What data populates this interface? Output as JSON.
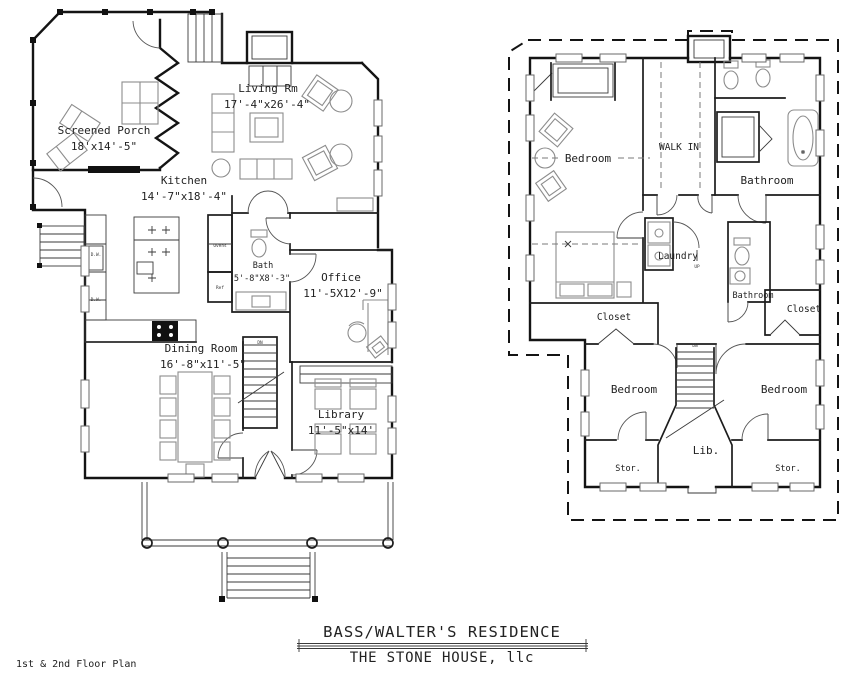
{
  "sheet": {
    "plan_note": "1st & 2nd Floor Plan",
    "title": "BASS/WALTER'S RESIDENCE",
    "firm": "THE STONE HOUSE, llc"
  },
  "style": {
    "ink": "#141414",
    "furniture": "#8c8c8c",
    "paper": "#ffffff"
  },
  "first_floor": {
    "rooms": [
      {
        "name": "Screened Porch",
        "dims": "18'x14'-5\""
      },
      {
        "name": "Living Rm",
        "dims": "17'-4\"x26'-4\""
      },
      {
        "name": "Kitchen",
        "dims": "14'-7\"x18'-4\""
      },
      {
        "name": "Bath",
        "dims": "5'-8\"X8'-3\""
      },
      {
        "name": "Office",
        "dims": "11'-5X12'-9\""
      },
      {
        "name": "Dining Room",
        "dims": "16'-8\"x11'-5\""
      },
      {
        "name": "Library",
        "dims": "11'-5\"x14'"
      }
    ],
    "labels": {
      "dw": "D.W.",
      "ovens": "Ovens",
      "ref": "Ref",
      "dn": "DN"
    }
  },
  "second_floor": {
    "rooms": [
      {
        "name": "Bedroom"
      },
      {
        "name": "WALK IN"
      },
      {
        "name": "Bathroom"
      },
      {
        "name": "Laundry"
      },
      {
        "name": "Bathroom"
      },
      {
        "name": "Closet"
      },
      {
        "name": "Closet"
      },
      {
        "name": "Bedroom"
      },
      {
        "name": "Bedroom"
      },
      {
        "name": "Lib."
      },
      {
        "name": "Stor."
      },
      {
        "name": "Stor."
      }
    ],
    "labels": {
      "dn": "DN",
      "up": "UP"
    }
  }
}
